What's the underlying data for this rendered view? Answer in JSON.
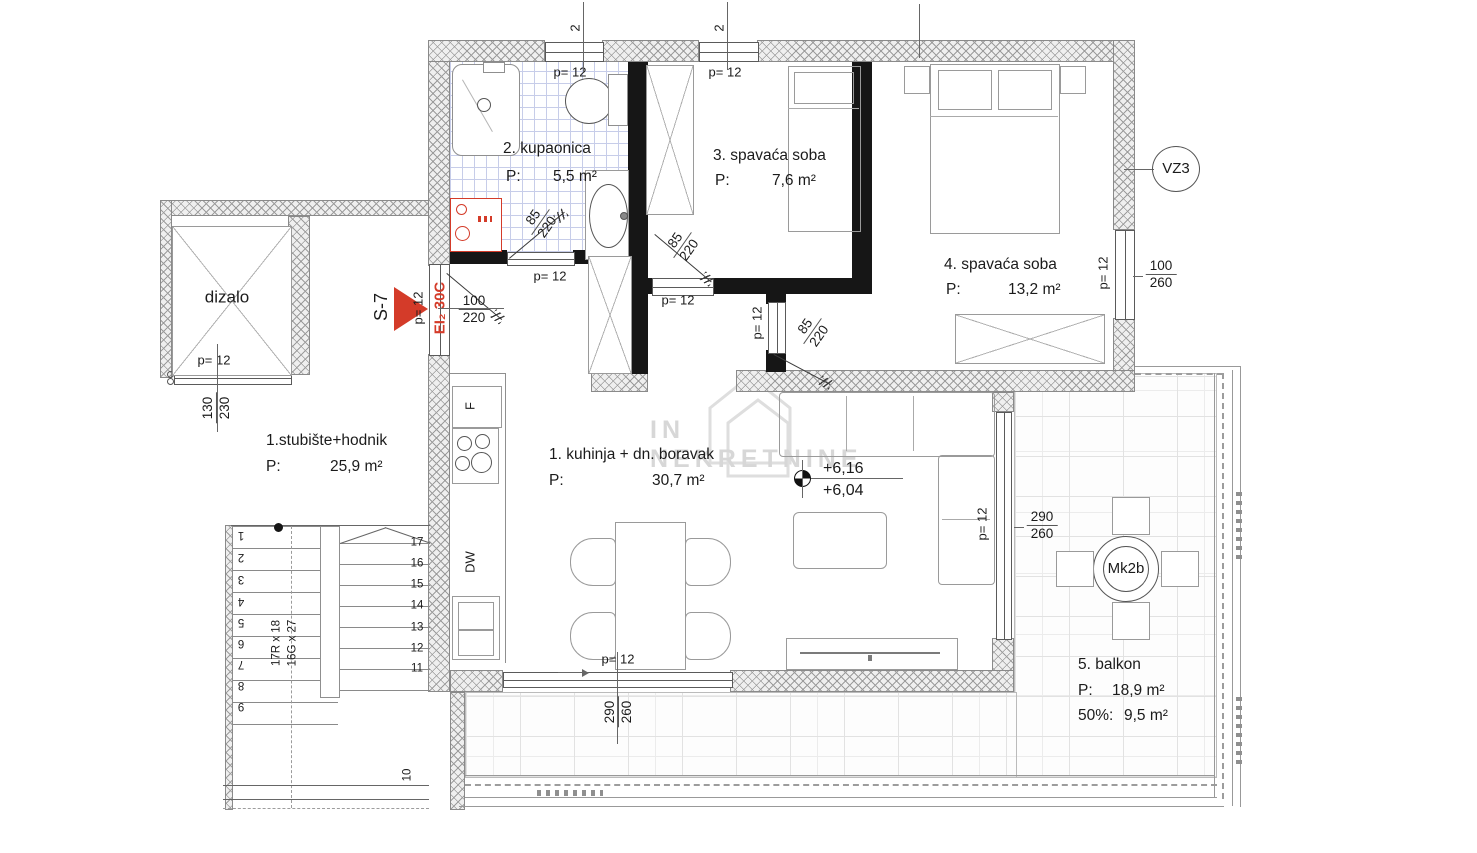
{
  "watermark": {
    "text": "IN NEKRETNINE"
  },
  "labels": {
    "p12": "p= 12",
    "win_num": "2"
  },
  "rooms": {
    "hall": {
      "name": "1.stubište+hodnik",
      "p": "P:",
      "area": "25,9 m²"
    },
    "bath": {
      "name": "2. kupaonica",
      "p": "P:",
      "area": "5,5 m²"
    },
    "bed3": {
      "name": "3. spavaća soba",
      "p": "P:",
      "area": "7,6 m²"
    },
    "bed4": {
      "name": "4. spavaća soba",
      "p": "P:",
      "area": "13,2 m²"
    },
    "living": {
      "name": "1. kuhinja + dn. boravak",
      "p": "P:",
      "area": "30,7 m²"
    },
    "balcony": {
      "name": "5. balkon",
      "p": "P:",
      "area": "18,9 m²",
      "half_label": "50%:",
      "half_area": "9,5 m²"
    },
    "elevator": {
      "name": "dizalo"
    }
  },
  "dims": {
    "elevator_door": {
      "top": "130",
      "bot": "230"
    },
    "entry_door": {
      "top": "100",
      "bot": "220"
    },
    "bath_door": {
      "top": "85",
      "bot": "220"
    },
    "bed3_door": {
      "top": "85",
      "bot": "220"
    },
    "bed4_door": {
      "top": "85",
      "bot": "220"
    },
    "bed4_window": {
      "top": "100",
      "bot": "260"
    },
    "balcony_door_east": {
      "top": "290",
      "bot": "260"
    },
    "balcony_door_south": {
      "top": "290",
      "bot": "260"
    }
  },
  "markers": {
    "unit": "S-7",
    "fire_door": "EI₂ 30C",
    "vent": "VZ3",
    "level_upper": "+6,16",
    "level_lower": "+6,04",
    "balcony_table": "Mk2b"
  },
  "kitchen": {
    "fridge": "F",
    "dishwasher": "DW"
  },
  "stairs": {
    "left": [
      "1",
      "2",
      "3",
      "4",
      "5",
      "6",
      "7",
      "8",
      "9"
    ],
    "right": [
      "17",
      "16",
      "15",
      "14",
      "13",
      "12",
      "11"
    ],
    "mid": "10",
    "risers": "17R x 18",
    "goings": "16G x 27"
  },
  "colors": {
    "accent_red": "#d43b29",
    "tile_blue": "#c7cde9",
    "watermark_gray": "#d7d7d7"
  }
}
